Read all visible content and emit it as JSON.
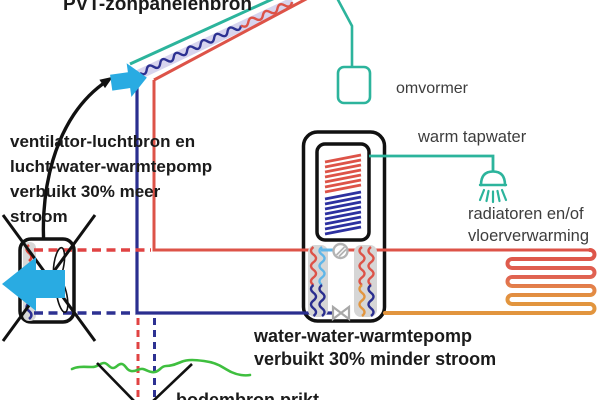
{
  "title": "PVT-zonpanelenbron",
  "labels": {
    "inverter": "omvormer",
    "hot_tap_water": "warm tapwater",
    "heating_emitters": "radiatoren en/of\nvloerverwarming"
  },
  "notes": {
    "air_source_heatpump": "ventilator-luchtbron en\nlucht-water-warmtepomp\nverbuikt 30% meer\nstroom",
    "water_water_heatpump": "water-water-warmtepomp\nverbuikt 30% minder stroom",
    "ground_source": "bodembron prikt"
  },
  "colors": {
    "teal": "#2cb49c",
    "red_pipe": "#dd5348",
    "navy_pipe": "#2a2e8f",
    "orange_pipe": "#e2953e",
    "dashed_red": "#e04343",
    "dashed_blue": "#2d3192",
    "cyan_arrow": "#29abe2",
    "ground_green": "#3fbf3f",
    "panel_lavender": "#d7d4ee",
    "hardware_gray": "#b3b3b3"
  }
}
